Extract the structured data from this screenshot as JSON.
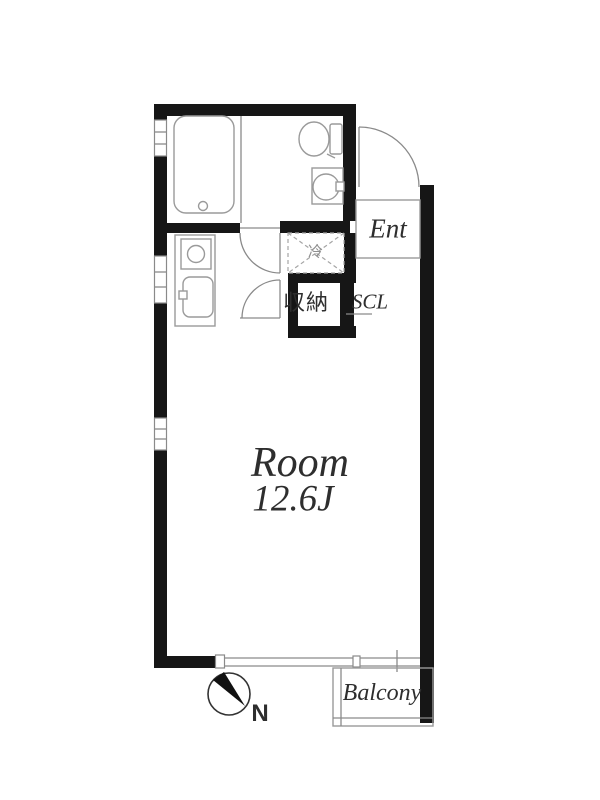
{
  "title": "Apartment floor plan",
  "labels": {
    "entrance": "Ent",
    "shoe_closet": "SCL",
    "storage": "収納",
    "refrigerator": "冷",
    "room_name": "Room",
    "room_size": "12.6J",
    "balcony": "Balcony",
    "compass_north": "N"
  },
  "colors": {
    "wall": "#161616",
    "line": "#8a8a8a",
    "fixture": "#9a9a9a",
    "dash": "#a5a5a5",
    "text": "#2e2e2e",
    "muted": "#8f8f8f",
    "bg": "#ffffff"
  }
}
